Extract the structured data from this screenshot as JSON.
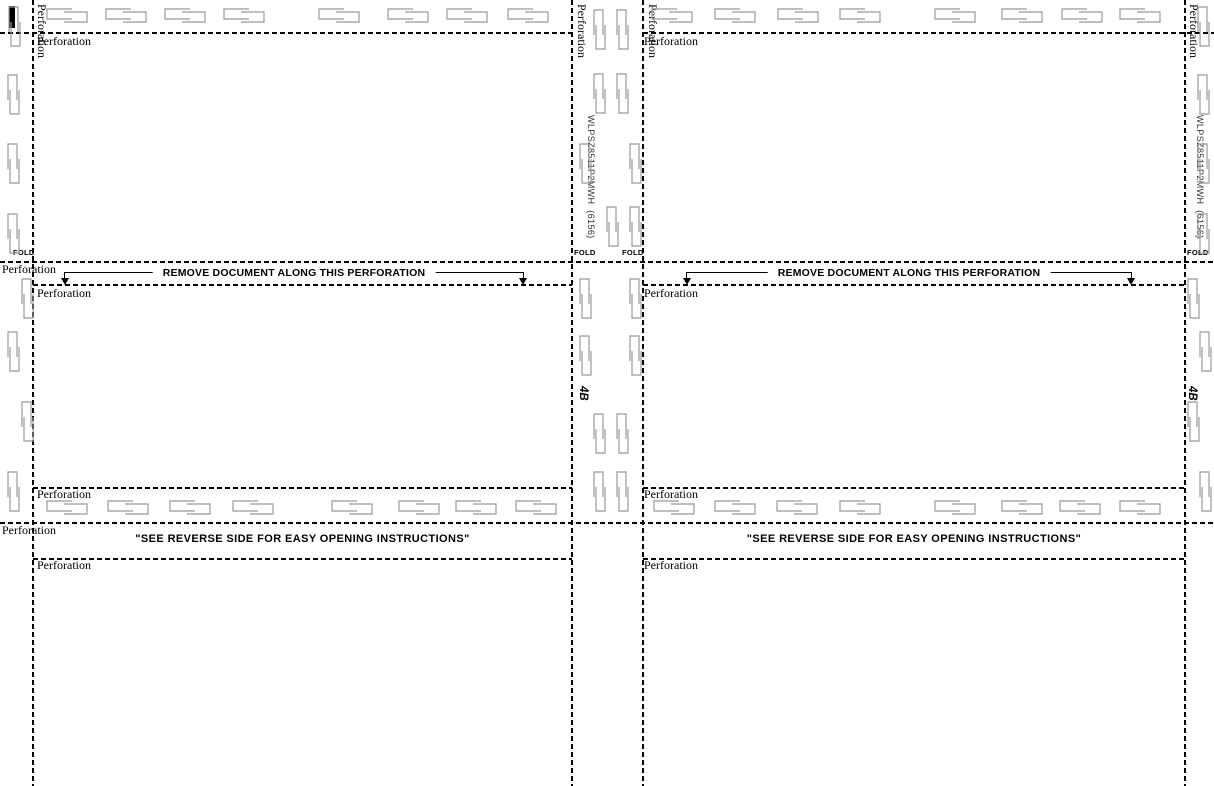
{
  "document": {
    "labels": {
      "perforation": "Perforation",
      "fold": "FOLD",
      "part_number": "WLPSZ8511P2MWH  (6156)",
      "form_code": "4B",
      "remove_banner": "REMOVE DOCUMENT ALONG THIS PERFORATION",
      "reverse_note": "\"SEE REVERSE SIDE FOR EASY OPENING INSTRUCTIONS\""
    },
    "colors": {
      "line": "#000000",
      "glue_tab": "#999999",
      "registration_mark": "#000000"
    }
  },
  "perforation_lines": {
    "vertical": [
      {
        "x": 33,
        "y1": 0,
        "y2": 786
      },
      {
        "x": 572,
        "y1": 0,
        "y2": 786
      },
      {
        "x": 643,
        "y1": 0,
        "y2": 786
      },
      {
        "x": 1185,
        "y1": 0,
        "y2": 786
      }
    ],
    "horizontal": [
      {
        "y": 33,
        "x1": 0,
        "x2": 572
      },
      {
        "y": 33,
        "x1": 643,
        "x2": 1214
      },
      {
        "y": 262,
        "x1": 0,
        "x2": 1214
      },
      {
        "y": 285,
        "x1": 33,
        "x2": 572
      },
      {
        "y": 285,
        "x1": 643,
        "x2": 1185
      },
      {
        "y": 488,
        "x1": 33,
        "x2": 572
      },
      {
        "y": 488,
        "x1": 643,
        "x2": 1185
      },
      {
        "y": 523,
        "x1": 0,
        "x2": 1214
      },
      {
        "y": 559,
        "x1": 33,
        "x2": 572
      },
      {
        "y": 559,
        "x1": 643,
        "x2": 1185
      }
    ]
  },
  "perforation_labels": {
    "horizontal_xy": [
      [
        37,
        35
      ],
      [
        644,
        35
      ],
      [
        2,
        263
      ],
      [
        37,
        287
      ],
      [
        644,
        287
      ],
      [
        37,
        488
      ],
      [
        644,
        488
      ],
      [
        2,
        524
      ],
      [
        37,
        559
      ],
      [
        644,
        559
      ]
    ],
    "vertical_xy": [
      [
        48,
        4
      ],
      [
        588,
        4
      ],
      [
        659,
        4
      ],
      [
        1200,
        4
      ]
    ]
  },
  "fold_labels_xy": [
    [
      13,
      249
    ],
    [
      574,
      249
    ],
    [
      622,
      249
    ],
    [
      1187,
      249
    ]
  ],
  "glue_pattern": {
    "horizontal_tabs_xy": [
      [
        45,
        7
      ],
      [
        104,
        7
      ],
      [
        163,
        7
      ],
      [
        222,
        7
      ],
      [
        317,
        7
      ],
      [
        386,
        7
      ],
      [
        445,
        7
      ],
      [
        506,
        7
      ],
      [
        650,
        7
      ],
      [
        713,
        7
      ],
      [
        776,
        7
      ],
      [
        838,
        7
      ],
      [
        933,
        7
      ],
      [
        1000,
        7
      ],
      [
        1060,
        7
      ],
      [
        1118,
        7
      ],
      [
        45,
        499
      ],
      [
        106,
        499
      ],
      [
        168,
        499
      ],
      [
        231,
        499
      ],
      [
        330,
        499
      ],
      [
        397,
        499
      ],
      [
        454,
        499
      ],
      [
        514,
        499
      ],
      [
        652,
        499
      ],
      [
        713,
        499
      ],
      [
        775,
        499
      ],
      [
        838,
        499
      ],
      [
        933,
        499
      ],
      [
        1000,
        499
      ],
      [
        1058,
        499
      ],
      [
        1118,
        499
      ]
    ],
    "vertical_tabs_xy": [
      [
        7,
        5
      ],
      [
        6,
        73
      ],
      [
        6,
        142
      ],
      [
        6,
        212
      ],
      [
        20,
        277
      ],
      [
        6,
        330
      ],
      [
        20,
        400
      ],
      [
        6,
        470
      ],
      [
        592,
        8
      ],
      [
        615,
        8
      ],
      [
        592,
        72
      ],
      [
        615,
        72
      ],
      [
        578,
        142
      ],
      [
        628,
        142
      ],
      [
        605,
        205
      ],
      [
        628,
        205
      ],
      [
        578,
        277
      ],
      [
        628,
        277
      ],
      [
        578,
        334
      ],
      [
        628,
        334
      ],
      [
        592,
        412
      ],
      [
        615,
        412
      ],
      [
        592,
        470
      ],
      [
        615,
        470
      ],
      [
        1196,
        5
      ],
      [
        1196,
        73
      ],
      [
        1196,
        142
      ],
      [
        1196,
        212
      ],
      [
        1186,
        277
      ],
      [
        1198,
        330
      ],
      [
        1186,
        400
      ],
      [
        1198,
        470
      ]
    ],
    "registration_mark": {
      "x": 9,
      "y": 6,
      "w": 6,
      "h": 22
    }
  },
  "banners": [
    {
      "left": 64,
      "top": 272,
      "width": 460
    },
    {
      "left": 686,
      "top": 272,
      "width": 446
    }
  ],
  "notes": [
    {
      "left": 33,
      "top": 533,
      "width": 539
    },
    {
      "left": 643,
      "top": 533,
      "width": 542
    }
  ]
}
